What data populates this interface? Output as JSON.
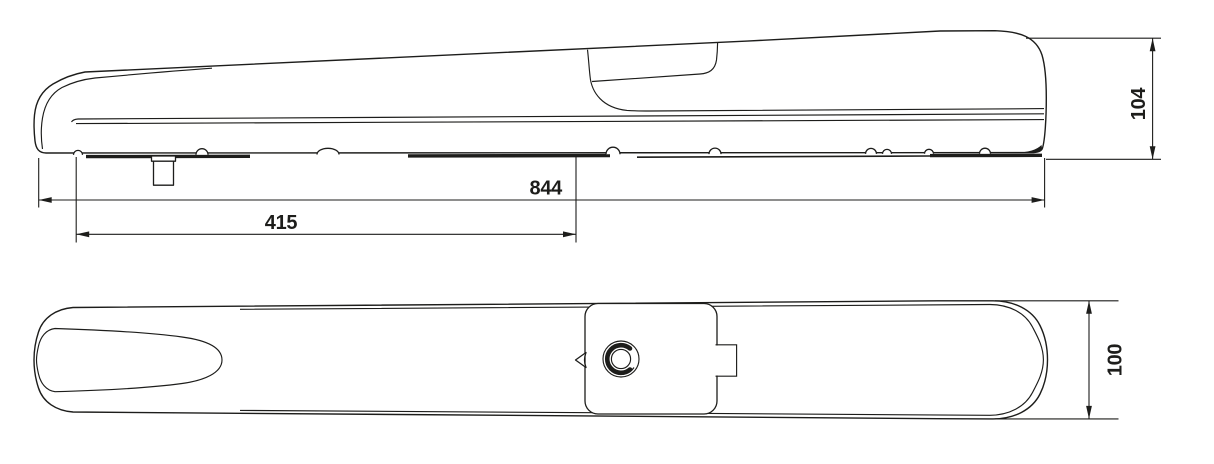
{
  "colors": {
    "background": "#ffffff",
    "line": "#1d1d1b"
  },
  "dims": {
    "side_total_length": "844",
    "side_partial_length": "415",
    "side_height": "104",
    "plan_width": "100"
  }
}
